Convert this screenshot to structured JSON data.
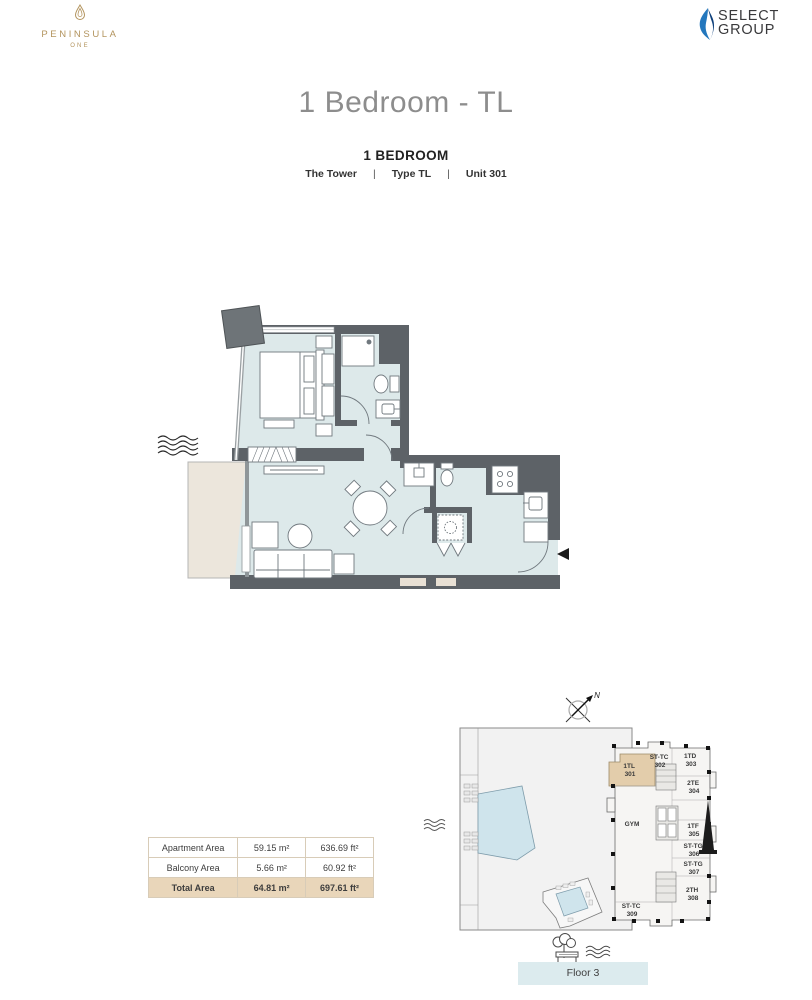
{
  "header": {
    "peninsula_logo": {
      "name": "PENINSULA",
      "sub": "ONE"
    },
    "select_logo": {
      "line1": "SELECT",
      "line2": "GROUP"
    },
    "title": "1 Bedroom - TL",
    "subtitle": {
      "heading": "1 BEDROOM",
      "tower": "The Tower",
      "separator": "|",
      "type": "Type TL",
      "unit": "Unit 301"
    }
  },
  "area_table": {
    "rows": [
      {
        "label": "Apartment Area",
        "sqm": "59.15 m²",
        "sqft": "636.69 ft²"
      },
      {
        "label": "Balcony Area",
        "sqm": "5.66 m²",
        "sqft": "60.92 ft²"
      },
      {
        "label": "Total Area",
        "sqm": "64.81 m²",
        "sqft": "697.61 ft²"
      }
    ]
  },
  "keyplan": {
    "compass": "N",
    "floor_label": "Floor 3",
    "units": [
      {
        "code": "1TL",
        "number": "301",
        "highlighted": true
      },
      {
        "code": "ST-TC",
        "number": "302"
      },
      {
        "code": "1TD",
        "number": "303"
      },
      {
        "code": "2TE",
        "number": "304"
      },
      {
        "code": "GYM",
        "number": ""
      },
      {
        "code": "1TF",
        "number": "305"
      },
      {
        "code": "ST-TG",
        "number": "306"
      },
      {
        "code": "ST-TG",
        "number": "307"
      },
      {
        "code": "2TH",
        "number": "308"
      },
      {
        "code": "ST-TC",
        "number": "309"
      }
    ]
  },
  "colors": {
    "accent_gold": "#b3945e",
    "select_blue": "#2377bd",
    "select_blue_dark": "#0d3f7a",
    "wall": "#5d6267",
    "floor": "#dde9ea",
    "balcony": "#ece6dc",
    "highlight_tan": "#e3cdab",
    "pool": "#cfe4ec",
    "floor_label_bg": "#dcebee",
    "table_total_bg": "#e9d6ba"
  }
}
